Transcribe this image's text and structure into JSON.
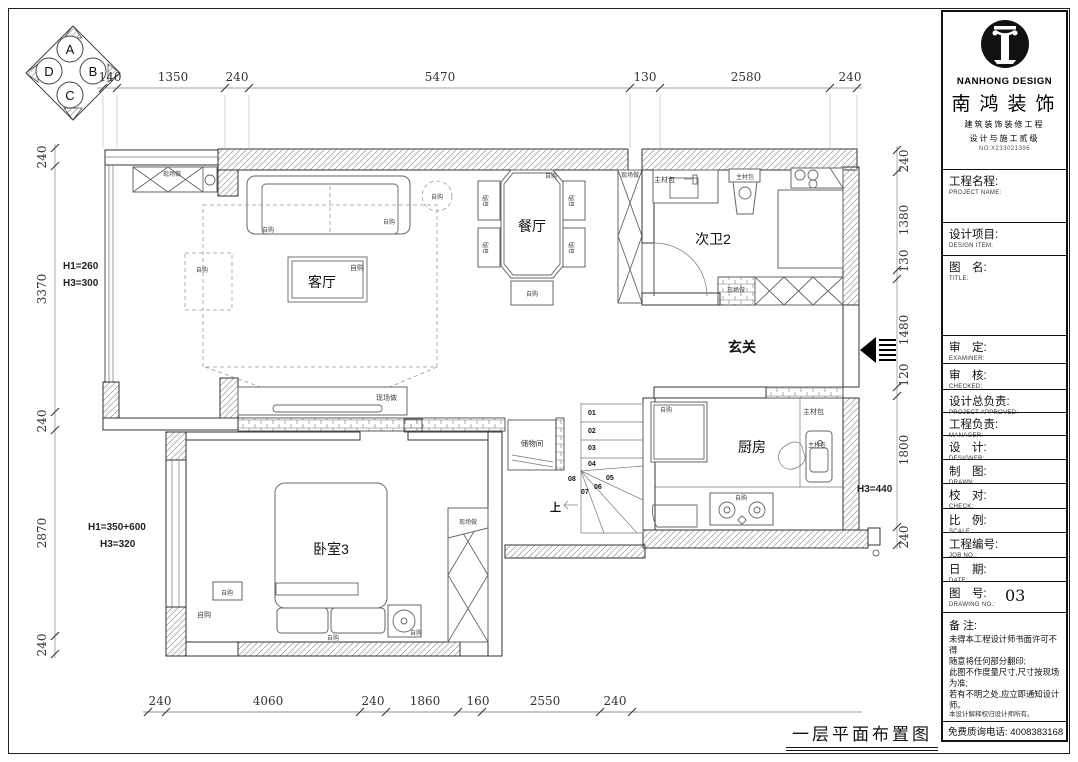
{
  "page": {
    "drawing_title": "一层平面布置图"
  },
  "title_block": {
    "brand_en": "NANHONG DESIGN",
    "brand": "南鸿装饰",
    "cert_line1": "建筑装饰装修工程",
    "cert_line2": "设计与施工贰级",
    "cert_no": "NO:X233021396",
    "fields": [
      {
        "cn": "工程名程:",
        "en": "PROJECT NAME:"
      },
      {
        "cn": "设计项目:",
        "en": "DESIGN ITEM:"
      },
      {
        "cn": "图　名:",
        "en": "TITLE:"
      },
      {
        "cn": "审　定:",
        "en": "EXAMINER:"
      },
      {
        "cn": "审　核:",
        "en": "CHECKED:"
      },
      {
        "cn": "设计总负责:",
        "en": "PROJECT APPROVED:"
      },
      {
        "cn": "工程负责:",
        "en": "MANAGER:"
      },
      {
        "cn": "设　计:",
        "en": "DESIGNER:"
      },
      {
        "cn": "制　图:",
        "en": "DRAWN:"
      },
      {
        "cn": "校　对:",
        "en": "CHECK:"
      },
      {
        "cn": "比　例:",
        "en": "SCALE:"
      },
      {
        "cn": "工程编号:",
        "en": "JOB NO.:"
      },
      {
        "cn": "日　期:",
        "en": "DATE:"
      },
      {
        "cn": "图　号:",
        "en": "DRAWING NO.:",
        "value": "03"
      }
    ],
    "notes_title": "备 注:",
    "notes": [
      "未得本工程设计师书面许可不得",
      "随意将任何部分翻印;",
      "此图不作度量尺寸,尺寸按现场",
      "为准;",
      "若有不明之处,应立即通知设计",
      "师。",
      "本设计解释权归设计师所有。"
    ],
    "hotline": "免费质询电话: 4008383168"
  },
  "dimensions": {
    "top": [
      "140",
      "1350",
      "240",
      "5470",
      "130",
      "2580",
      "240"
    ],
    "left": [
      "240",
      "3370",
      "240",
      "2870",
      "240"
    ],
    "right": [
      "240",
      "1380",
      "130",
      "1480",
      "120",
      "1800",
      "240"
    ],
    "bottom": [
      "240",
      "4060",
      "240",
      "1860",
      "160",
      "2550",
      "240"
    ]
  },
  "rooms": {
    "living": "客厅",
    "dining": "餐厅",
    "bath": "次卫2",
    "entry": "玄关",
    "kitchen": "厨房",
    "bedroom": "卧室3",
    "storage": "储物间"
  },
  "annotations": {
    "h_left_1": "H1=260",
    "h_left_2": "H3=300",
    "h_left_3": "H1=350+600",
    "h_left_4": "H3=320",
    "h_right": "H3=440",
    "up": "上"
  },
  "tags": {
    "site_made": "现场做",
    "self_buy": "自购",
    "material_pkg": "主材包"
  },
  "stairs": [
    "01",
    "02",
    "03",
    "04",
    "05",
    "06",
    "07",
    "08"
  ],
  "elevation_marker": [
    "A",
    "B",
    "C",
    "D"
  ]
}
